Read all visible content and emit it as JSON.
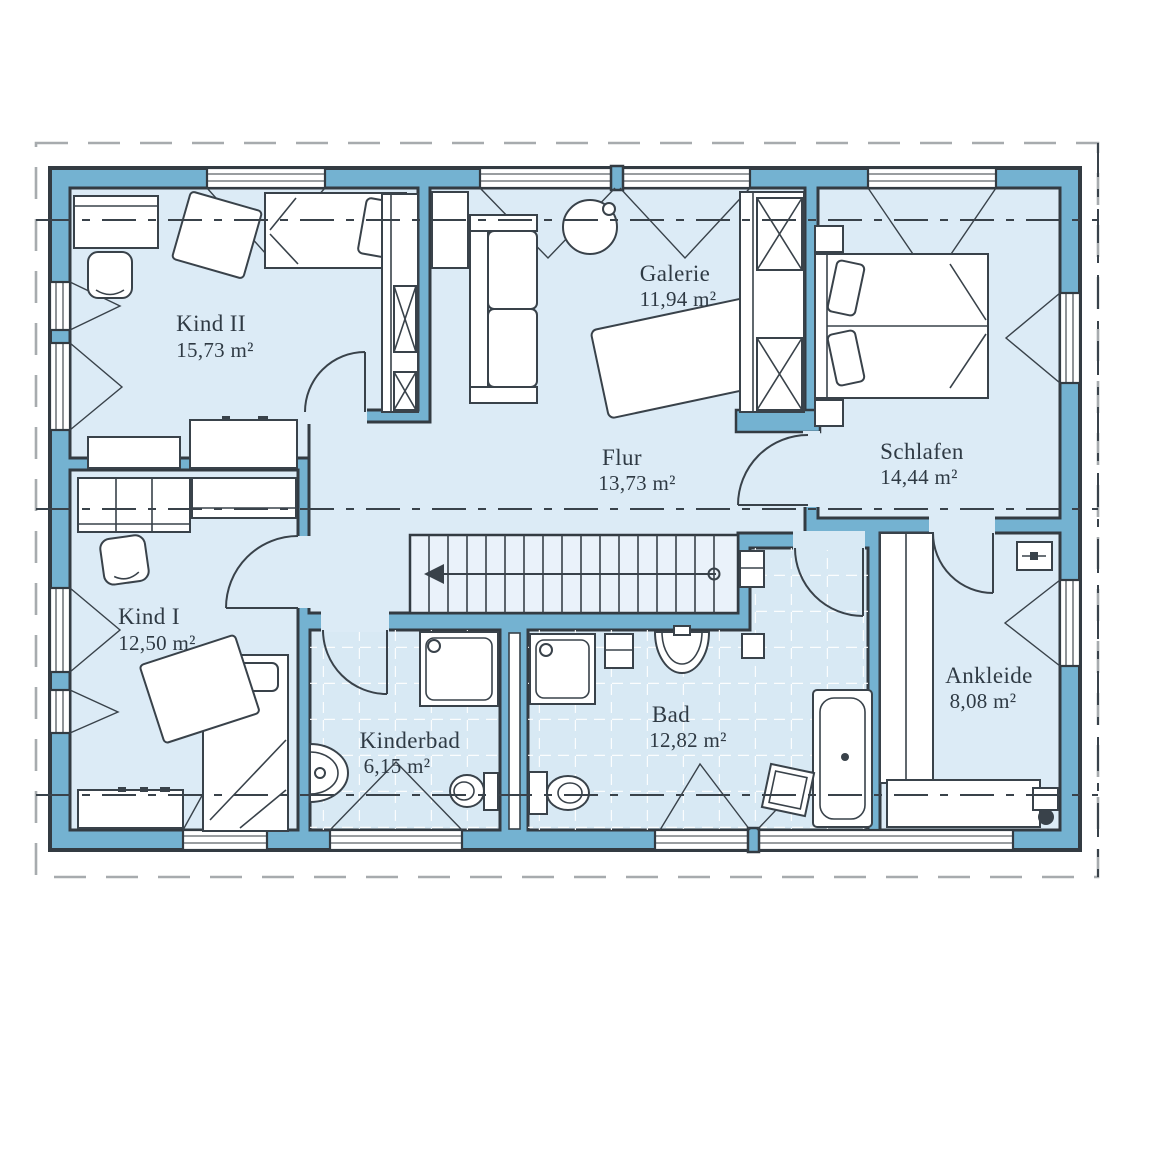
{
  "palette": {
    "wall_blue": "#74B2D1",
    "floor_light_blue": "#DCEBF6",
    "bath_tile_blue": "#D8E9F4",
    "stair_blue": "#EAF2FA",
    "outline_dark": "#333B42",
    "text_dark": "#2F3A44",
    "boundary_gray": "#A7ABAE",
    "background": "#FFFFFF"
  },
  "rooms": {
    "kind2": {
      "name": "Kind II",
      "area": "15,73 m²"
    },
    "galerie": {
      "name": "Galerie",
      "area": "11,94 m²"
    },
    "schlafen": {
      "name": "Schlafen",
      "area": "14,44 m²"
    },
    "flur": {
      "name": "Flur",
      "area": "13,73 m²"
    },
    "kind1": {
      "name": "Kind I",
      "area": "12,50 m²"
    },
    "kinderbad": {
      "name": "Kinderbad",
      "area": "6,15 m²"
    },
    "bad": {
      "name": "Bad",
      "area": "12,82 m²"
    },
    "ankleide": {
      "name": "Ankleide",
      "area": "8,08 m²"
    }
  }
}
